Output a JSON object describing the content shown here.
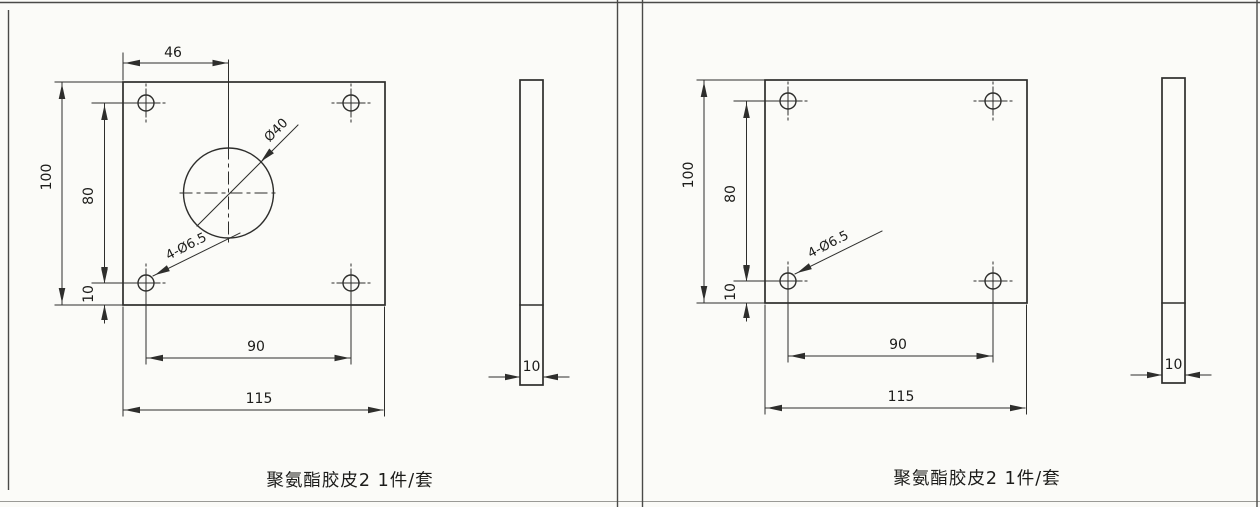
{
  "colors": {
    "line": "#2e2e2c",
    "ink": "#1c1c1a",
    "background": "#fbfbf8",
    "border": "#4a4a48"
  },
  "panels": [
    {
      "caption": "聚氨酯胶皮2 1件/套",
      "dims": {
        "hole_x_offset": "46",
        "plate_height": "100",
        "hole_span_vertical": "80",
        "hole_bottom_offset": "10",
        "hole_span_horizontal": "90",
        "plate_width": "115",
        "corner_holes": "4-Ø6.5",
        "center_hole_diameter": "Ø40",
        "thickness": "10"
      }
    },
    {
      "caption": "聚氨酯胶皮2 1件/套",
      "dims": {
        "plate_height": "100",
        "hole_span_vertical": "80",
        "hole_bottom_offset": "10",
        "hole_span_horizontal": "90",
        "plate_width": "115",
        "corner_holes": "4-Ø6.5",
        "thickness": "10"
      }
    }
  ]
}
